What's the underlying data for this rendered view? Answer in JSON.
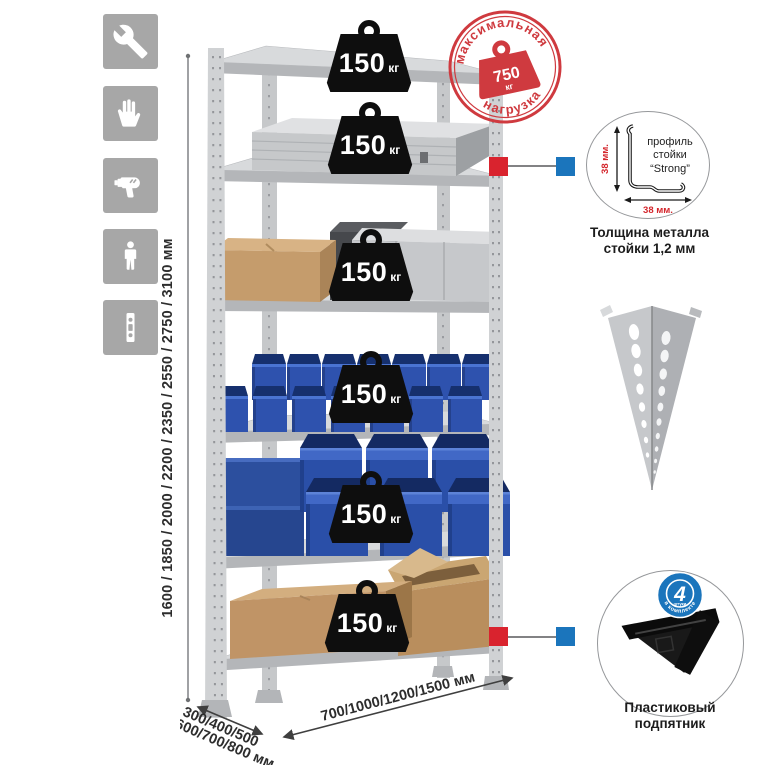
{
  "app": {
    "type": "product-infographic",
    "background": "#ffffff"
  },
  "sidebar": {
    "icons": [
      {
        "name": "wrench-icon"
      },
      {
        "name": "gloves-icon"
      },
      {
        "name": "drill-icon"
      },
      {
        "name": "person-icon"
      },
      {
        "name": "perforated-post-icon"
      }
    ]
  },
  "shelving": {
    "shelf_count": 6,
    "badges": [
      {
        "value": "150",
        "unit": "кг"
      },
      {
        "value": "150",
        "unit": "кг"
      },
      {
        "value": "150",
        "unit": "кг"
      },
      {
        "value": "150",
        "unit": "кг"
      },
      {
        "value": "150",
        "unit": "кг"
      },
      {
        "value": "150",
        "unit": "кг"
      }
    ]
  },
  "stamp": {
    "arc_top": "максимальная",
    "arc_bottom": "нагрузка",
    "value": "750",
    "unit": "кг"
  },
  "dimensions": {
    "height": "1600 / 1850 / 2000 / 2200 / 2350 / 2550 / 2750 / 3100 мм",
    "depth_line1": "300/400/500",
    "depth_line2": "600/700/800 мм",
    "width": "700/1000/1200/1500 мм"
  },
  "profile_detail": {
    "label_line1": "профиль",
    "label_line2": "стойки",
    "label_line3": "“Strong”",
    "dim_vertical": "38 мм.",
    "dim_horizontal": "38 мм.",
    "caption_line1": "Толщина металла",
    "caption_line2": "стойки 1,2 мм"
  },
  "foot_detail": {
    "badge_value": "4",
    "badge_small": "штуки",
    "badge_arc": "в комплекте",
    "caption_line1": "Пластиковый",
    "caption_line2": "подпятник"
  },
  "colors": {
    "accent_red": "#d9232e",
    "accent_blue": "#1b75bc",
    "stamp_red": "#cf3a3f",
    "bin_blue": "#2e52ae",
    "metal_gray": "#d0d2d4",
    "icon_gray": "#a7a7a7"
  }
}
